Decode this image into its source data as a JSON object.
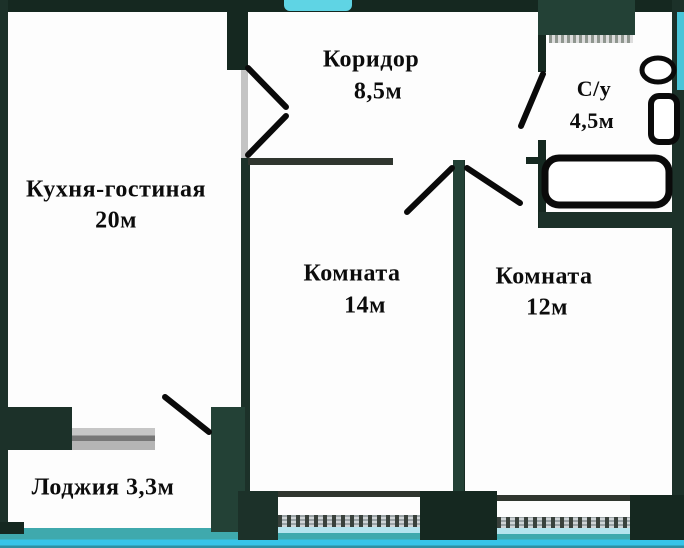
{
  "title": "Квартира — план этажа",
  "rooms": [
    {
      "name": "Кухня-гостиная",
      "area": "20м"
    },
    {
      "name": "Коридор",
      "area": "8,5м"
    },
    {
      "name": "С/у",
      "area": "4,5м"
    },
    {
      "name": "Комната",
      "area": "14м"
    },
    {
      "name": "Комната",
      "area": "12м"
    },
    {
      "name": "Лоджия",
      "area": "3,3м"
    }
  ],
  "fixtures": [
    "toilet",
    "sink",
    "bathtub"
  ],
  "colors": {
    "wall_dark_green": "#1c3129",
    "room_fill": "#fdfdfd",
    "scan_cyan": "#55cfe2",
    "door_line": "#0a0a0a",
    "window_grey": "#c2c2c2",
    "text": "#0c0c0c"
  }
}
